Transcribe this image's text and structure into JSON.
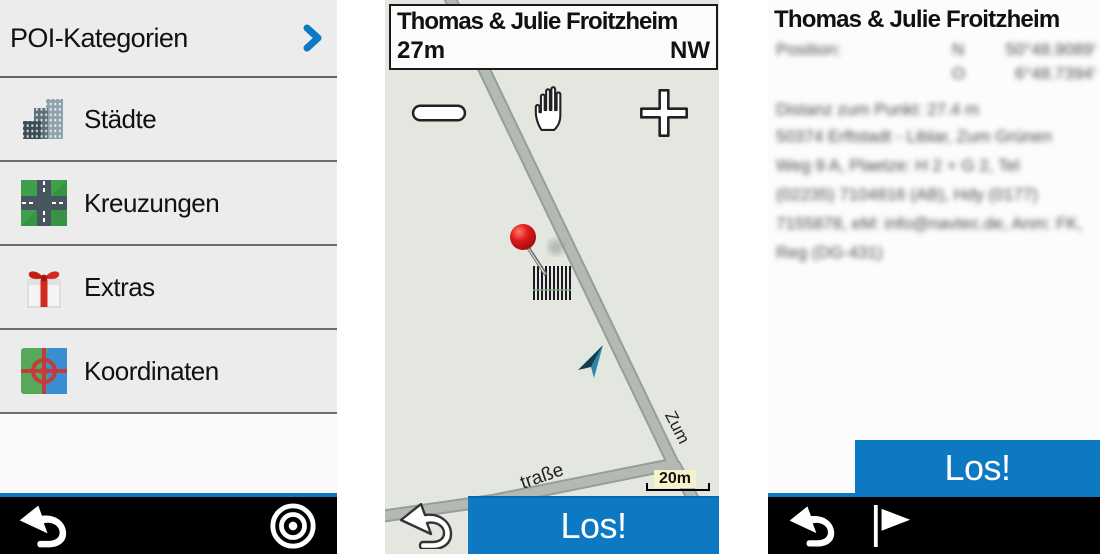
{
  "accent_color": "#0d79c2",
  "left_panel": {
    "header": {
      "label": "POI-Kategorien",
      "chevron_icon": "chevron-right"
    },
    "items": [
      {
        "label": "Städte",
        "icon": "city-buildings-icon"
      },
      {
        "label": "Kreuzungen",
        "icon": "road-intersection-icon"
      },
      {
        "label": "Extras",
        "icon": "gift-icon"
      },
      {
        "label": "Koordinaten",
        "icon": "map-crosshair-icon"
      }
    ],
    "footer": {
      "back_icon": "back-arrow",
      "target_icon": "bullseye-target"
    }
  },
  "map_panel": {
    "header": {
      "title": "Thomas & Julie Froitzheim",
      "distance": "27m",
      "direction": "NW"
    },
    "controls": {
      "zoom_out_icon": "minus",
      "pan_icon": "hand",
      "zoom_in_icon": "plus"
    },
    "street_label_1": "traße",
    "street_label_2": "Zum",
    "scale_label": "20m",
    "go_button": "Los!",
    "back_icon": "back-arrow-outline",
    "pin_icon": "red-pushpin",
    "cursor_icon": "position-arrow"
  },
  "detail_panel": {
    "title": "Thomas & Julie Froitzheim",
    "blurred": {
      "position_label": "Position:",
      "lat_hemisphere": "N",
      "lat_value": "50°48.9089'",
      "lon_hemisphere": "O",
      "lon_value": "6°48.7394'",
      "distance_line": "Distanz zum Punkt: 27.4 m",
      "address_lines": [
        "50374 Erftstadt - Liblar, Zum Grünen",
        "Weg 9 A, Plaetze: H 2 + G 2, Tel",
        "(02235) 7104816 (AB), Hdy (0177)",
        "7155878, eM: info@navtec.de, Anm: FK,",
        "Reg (DG-431)"
      ]
    },
    "go_button": "Los!",
    "footer": {
      "back_icon": "back-arrow",
      "flag_icon": "flag"
    }
  }
}
